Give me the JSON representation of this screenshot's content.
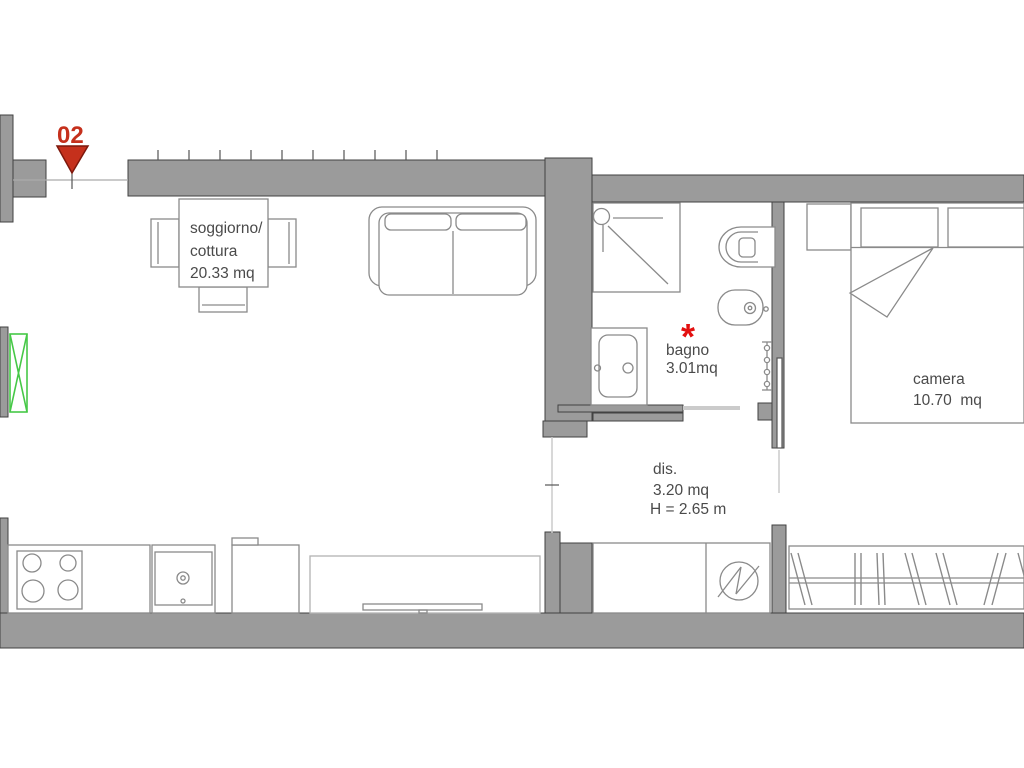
{
  "plan": {
    "marker_number": "02",
    "rooms": {
      "soggiorno": {
        "line1": "soggiorno/",
        "line2": "cottura",
        "line3": "20.33 mq"
      },
      "bagno": {
        "line1": "bagno",
        "line2": "3.01mq",
        "star": "*"
      },
      "dis": {
        "line1": "dis.",
        "line2": "3.20 mq",
        "line3": "H = 2.65 m"
      },
      "camera": {
        "line1": "camera",
        "line2": "10.70  mq"
      }
    },
    "colors": {
      "wall_fill": "#9b9b9b",
      "wall_stroke": "#424242",
      "furniture_stroke": "#8a8a8a",
      "sideboard_stroke": "#b2b2b2",
      "light_stroke": "#cbcbcb",
      "text_color": "#4a4a4a",
      "marker_red": "#c5301c",
      "asterisk_red": "#e31010",
      "window_green": "#46c847"
    }
  }
}
